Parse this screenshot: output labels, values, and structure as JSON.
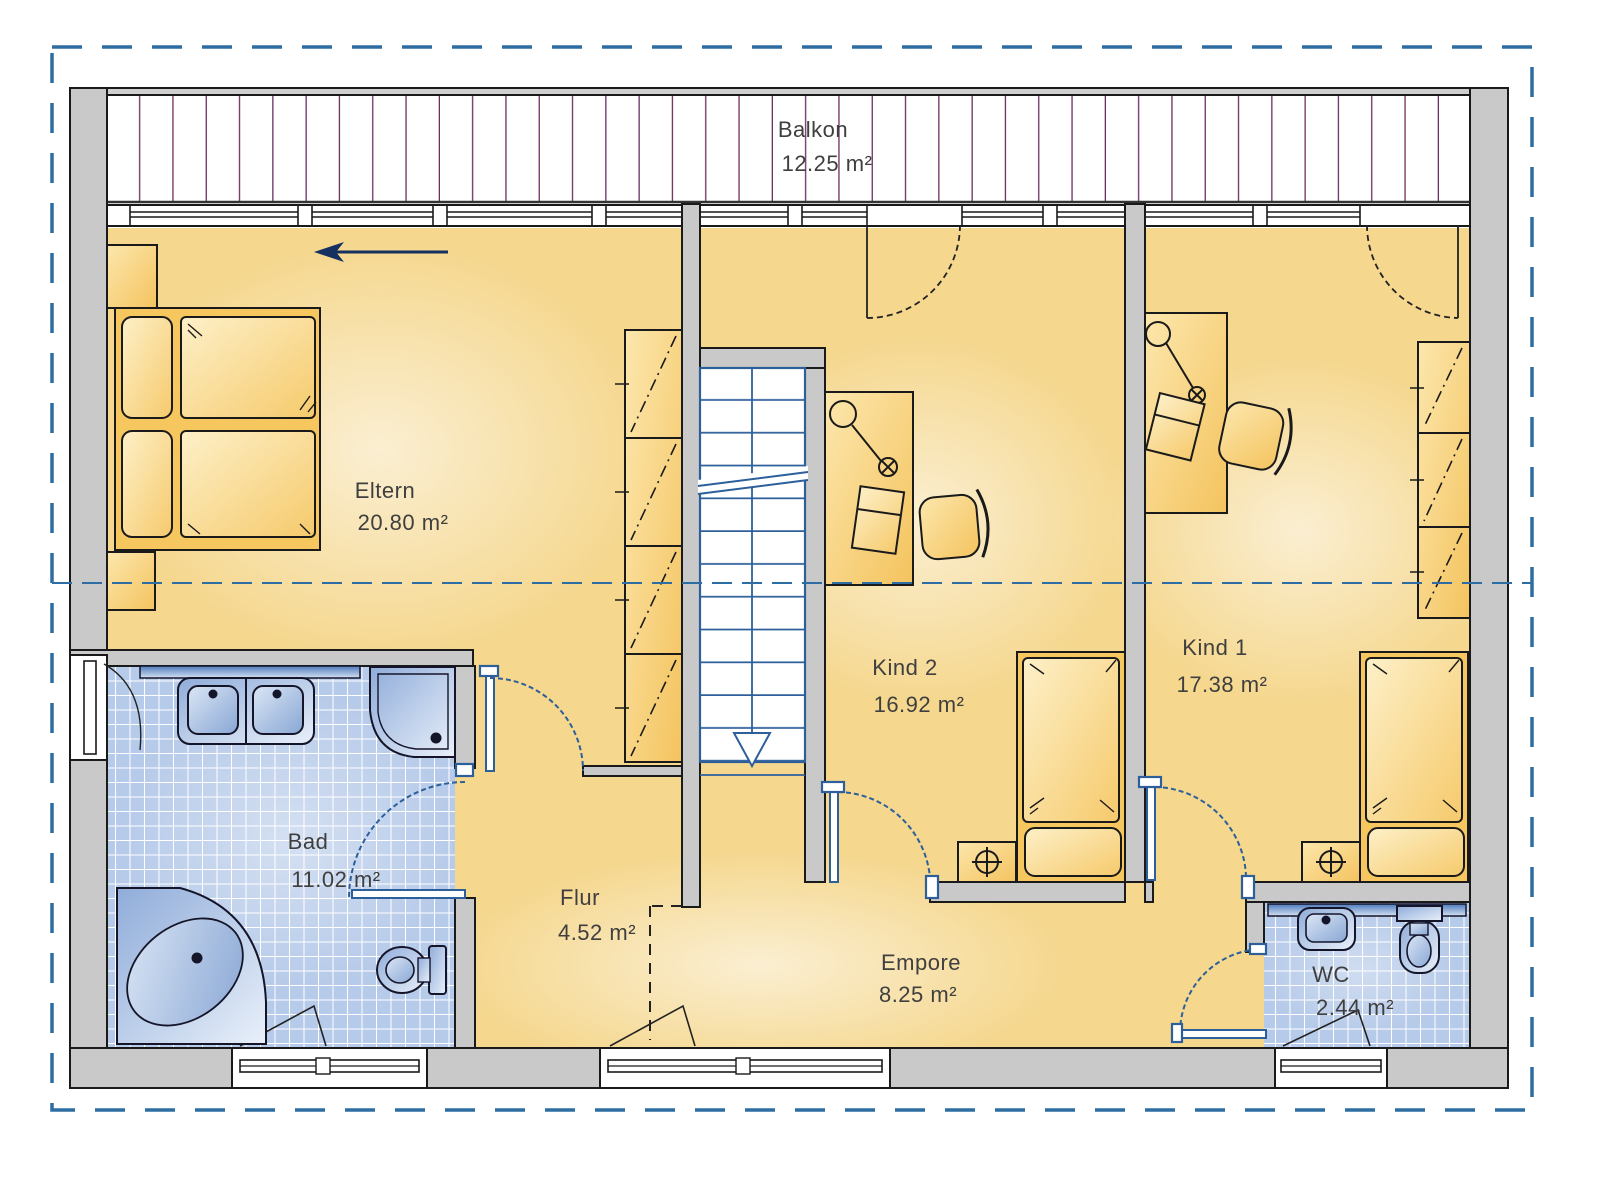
{
  "drawing_type": "floor-plan",
  "rooms": {
    "balkon": {
      "name": "Balkon",
      "area": "12.25 m²"
    },
    "eltern": {
      "name": "Eltern",
      "area": "20.80 m²"
    },
    "kind2": {
      "name": "Kind 2",
      "area": "16.92 m²"
    },
    "kind1": {
      "name": "Kind 1",
      "area": "17.38 m²"
    },
    "bad": {
      "name": "Bad",
      "area": "11.02 m²"
    },
    "flur": {
      "name": "Flur",
      "area": "4.52 m²"
    },
    "empore": {
      "name": "Empore",
      "area": "8.25 m²"
    },
    "wc": {
      "name": "WC",
      "area": "2.44 m²"
    }
  },
  "colors": {
    "floor": "#f5d78e",
    "floor_light": "#fdf0c8",
    "furniture": "#f6c65f",
    "wall": "#c9c9c9",
    "outline": "#1a1a1a",
    "tile": "#b6cae9",
    "fixture_blue": "#8facd9",
    "accent_blue": "#2d5f9b",
    "deck_line": "#6e2d60",
    "border_blue": "#2e6da4",
    "text": "#3f3f3f"
  }
}
